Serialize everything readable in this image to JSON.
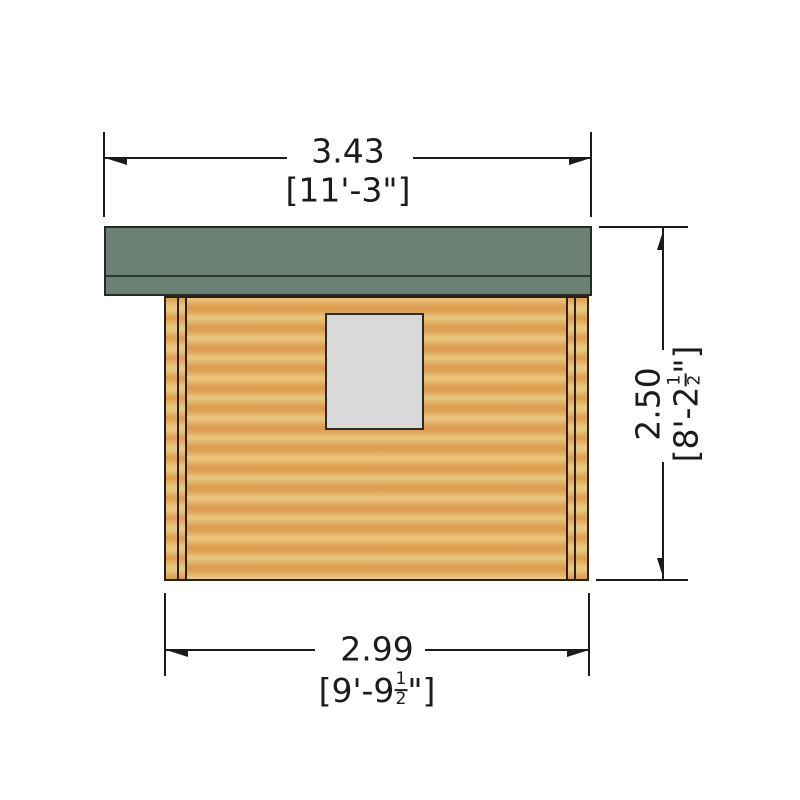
{
  "drawing": {
    "type": "shed side elevation technical drawing",
    "parts": [
      "roof",
      "log wall",
      "window"
    ]
  },
  "colors": {
    "line": "#1b1b1b",
    "roof-green": "#6b8176",
    "roof-outline": "#232a24",
    "wood-light": "#e8c87f",
    "wood-dark": "#dd9d4f",
    "wall-outline": "#2a2015",
    "window-grey": "#d9d9d9",
    "window-outline": "#2b2b2b"
  },
  "dimensions": {
    "top_width": {
      "metric": "3.43",
      "imperial": "[11'-3\"]"
    },
    "right_height": {
      "metric": "2.50",
      "imperial_prefix": "[8'-2",
      "fraction_numerator": "1",
      "fraction_denominator": "2",
      "imperial_suffix": "\"]"
    },
    "bottom_width": {
      "metric": "2.99",
      "imperial_prefix": "[9'-9",
      "fraction_numerator": "1",
      "fraction_denominator": "2",
      "imperial_suffix": "\"]"
    }
  }
}
